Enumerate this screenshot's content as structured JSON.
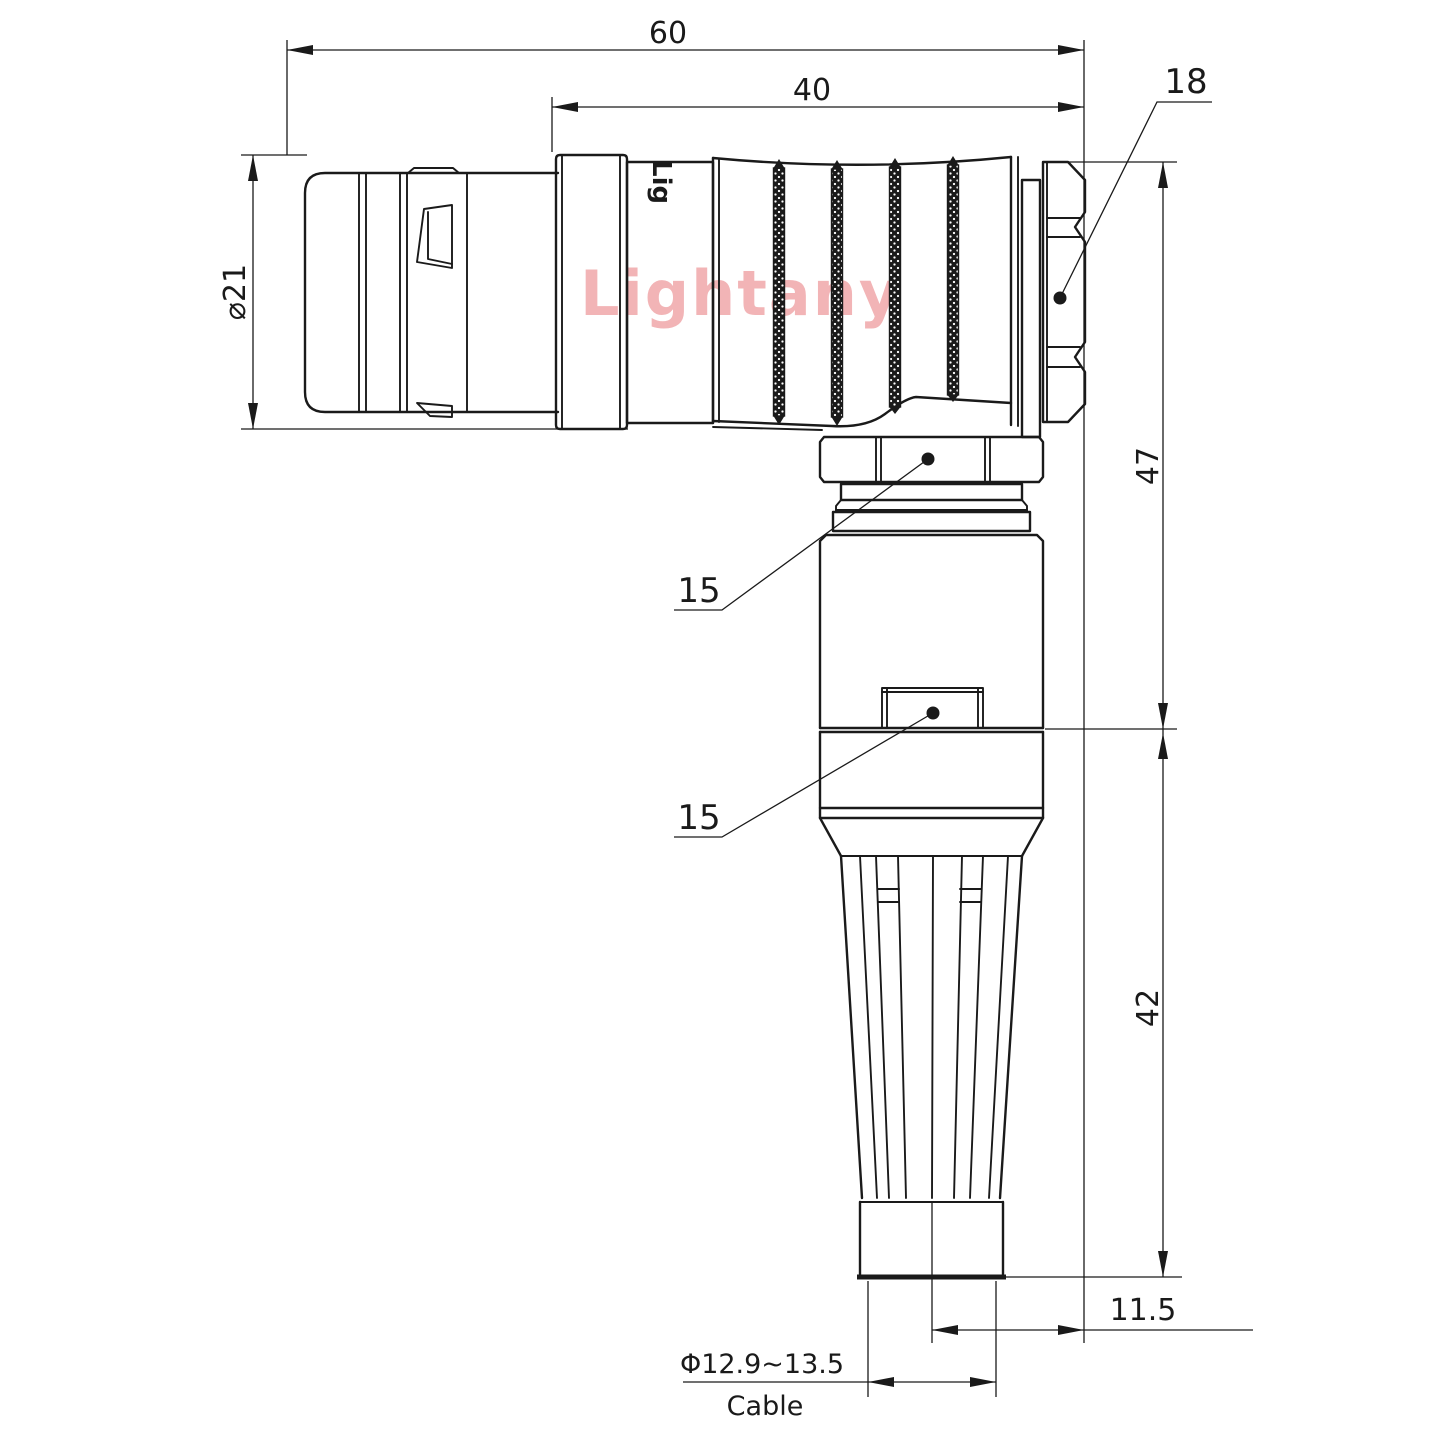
{
  "drawing": {
    "background": "#ffffff",
    "ink_color": "#1a1a1a",
    "watermark": {
      "text": "Lightany",
      "color": "#f2b4b6"
    },
    "part_marking": "Lig",
    "dims": {
      "overall_length": "60",
      "boot_length": "40",
      "nut_across_flats": "18",
      "plug_diameter": "⌀21",
      "upper_height": "47",
      "lower_height": "42",
      "gland_hex": "15",
      "body_hex": "15",
      "cable_offset": "11.5",
      "cable_diameter": "Φ12.9~13.5",
      "cable_caption": "Cable"
    }
  }
}
